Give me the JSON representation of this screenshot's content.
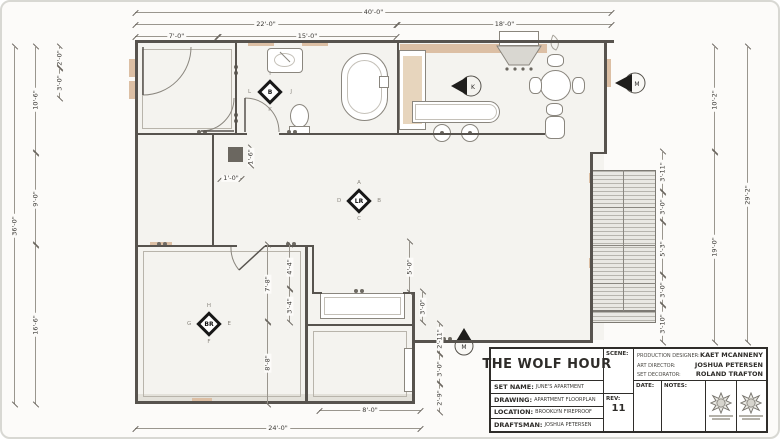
{
  "drawing": {
    "dimensions": [
      {
        "label": "40'-0\"",
        "o": "h",
        "x": 133,
        "y": 10,
        "l": 477
      },
      {
        "label": "22'-0\"",
        "o": "h",
        "x": 133,
        "y": 22,
        "l": 262
      },
      {
        "label": "18'-0\"",
        "o": "h",
        "x": 395,
        "y": 22,
        "l": 215
      },
      {
        "label": "7'-0\"",
        "o": "h",
        "x": 133,
        "y": 34,
        "l": 83
      },
      {
        "label": "15'-0\"",
        "o": "h",
        "x": 216,
        "y": 34,
        "l": 179
      },
      {
        "label": "36'-0\"",
        "o": "v",
        "x": 12,
        "y": 45,
        "l": 357
      },
      {
        "label": "10'-6\"",
        "o": "v",
        "x": 33,
        "y": 45,
        "l": 106
      },
      {
        "label": "9'-0\"",
        "o": "v",
        "x": 33,
        "y": 151,
        "l": 92
      },
      {
        "label": "16'-6\"",
        "o": "v",
        "x": 33,
        "y": 243,
        "l": 159
      },
      {
        "label": "2'-0\"",
        "o": "v",
        "x": 57,
        "y": 45,
        "l": 21
      },
      {
        "label": "3'-0\"",
        "o": "v",
        "x": 57,
        "y": 66,
        "l": 30
      },
      {
        "label": "29'-2\"",
        "o": "v",
        "x": 745,
        "y": 45,
        "l": 295
      },
      {
        "label": "10'-2\"",
        "o": "v",
        "x": 712,
        "y": 45,
        "l": 105
      },
      {
        "label": "19'-0\"",
        "o": "v",
        "x": 712,
        "y": 150,
        "l": 190
      },
      {
        "label": "3'-11\"",
        "o": "v",
        "x": 660,
        "y": 150,
        "l": 40
      },
      {
        "label": "3'-0\"",
        "o": "v",
        "x": 660,
        "y": 190,
        "l": 30
      },
      {
        "label": "5'-3\"",
        "o": "v",
        "x": 660,
        "y": 220,
        "l": 53
      },
      {
        "label": "3'-0\"",
        "o": "v",
        "x": 660,
        "y": 273,
        "l": 30
      },
      {
        "label": "3'-10\"",
        "o": "v",
        "x": 660,
        "y": 303,
        "l": 37
      },
      {
        "label": "24'-0\"",
        "o": "h",
        "x": 133,
        "y": 426,
        "l": 286
      },
      {
        "label": "8'-0\"",
        "o": "h",
        "x": 317,
        "y": 408,
        "l": 102
      },
      {
        "label": "2'-11\"",
        "o": "v",
        "x": 437,
        "y": 322,
        "l": 30
      },
      {
        "label": "3'-0\"",
        "o": "v",
        "x": 437,
        "y": 352,
        "l": 30
      },
      {
        "label": "2'-9\"",
        "o": "v",
        "x": 437,
        "y": 382,
        "l": 28
      },
      {
        "label": "7'-8\"",
        "o": "v",
        "x": 265,
        "y": 243,
        "l": 77
      },
      {
        "label": "8'-8\"",
        "o": "v",
        "x": 265,
        "y": 320,
        "l": 82
      },
      {
        "label": "4'-4\"",
        "o": "v",
        "x": 287,
        "y": 243,
        "l": 44
      },
      {
        "label": "3'-4\"",
        "o": "v",
        "x": 287,
        "y": 287,
        "l": 33
      },
      {
        "label": "5'-0\"",
        "o": "v",
        "x": 407,
        "y": 240,
        "l": 50
      },
      {
        "label": "3'-0\"",
        "o": "v",
        "x": 420,
        "y": 290,
        "l": 30
      },
      {
        "label": "1'-6\"",
        "o": "v",
        "x": 248,
        "y": 146,
        "l": 17
      },
      {
        "label": "1'-0\"",
        "o": "h",
        "x": 218,
        "y": 176,
        "l": 22
      }
    ],
    "markers": {
      "living": {
        "label": "LR",
        "points": [
          "A",
          "B",
          "C",
          "D"
        ]
      },
      "bedroom": {
        "label": "BR",
        "points": [
          "H",
          "E",
          "F",
          "G"
        ]
      },
      "bathroom": {
        "label": "B",
        "points": [
          "I",
          "J",
          "K",
          "L"
        ]
      },
      "cam_kitchen": "K",
      "cam_right": "M",
      "cam_bottom": "M"
    },
    "colors": {
      "sheet": "#fcfbf9",
      "wall": "#57534e",
      "millwork_tan": "#dcbfa4",
      "hatch": "#b7b5ae"
    }
  },
  "title_block": {
    "title": "THE WOLF HOUR",
    "set_name_label": "SET NAME:",
    "set_name": "JUNE'S APARTMENT",
    "drawing_label": "DRAWING:",
    "drawing": "APARTMENT FLOORPLAN",
    "location_label": "LOCATION:",
    "location": "BROOKLYN FIREPROOF",
    "draftsman_label": "DRAFTSMAN:",
    "draftsman": "JOSHUA PETERSEN",
    "scene_label": "SCENE:",
    "scene": "",
    "rev_label": "REV:",
    "rev": "11",
    "date_label": "DATE:",
    "notes_label": "NOTES:",
    "credits": [
      {
        "label": "PRODUCTION DESIGNER:",
        "value": "KAET MCANNENY"
      },
      {
        "label": "ART DIRECTOR:",
        "value": "JOSHUA PETERSEN"
      },
      {
        "label": "SET DECORATOR:",
        "value": "ROLAND TRAFTON"
      }
    ]
  }
}
